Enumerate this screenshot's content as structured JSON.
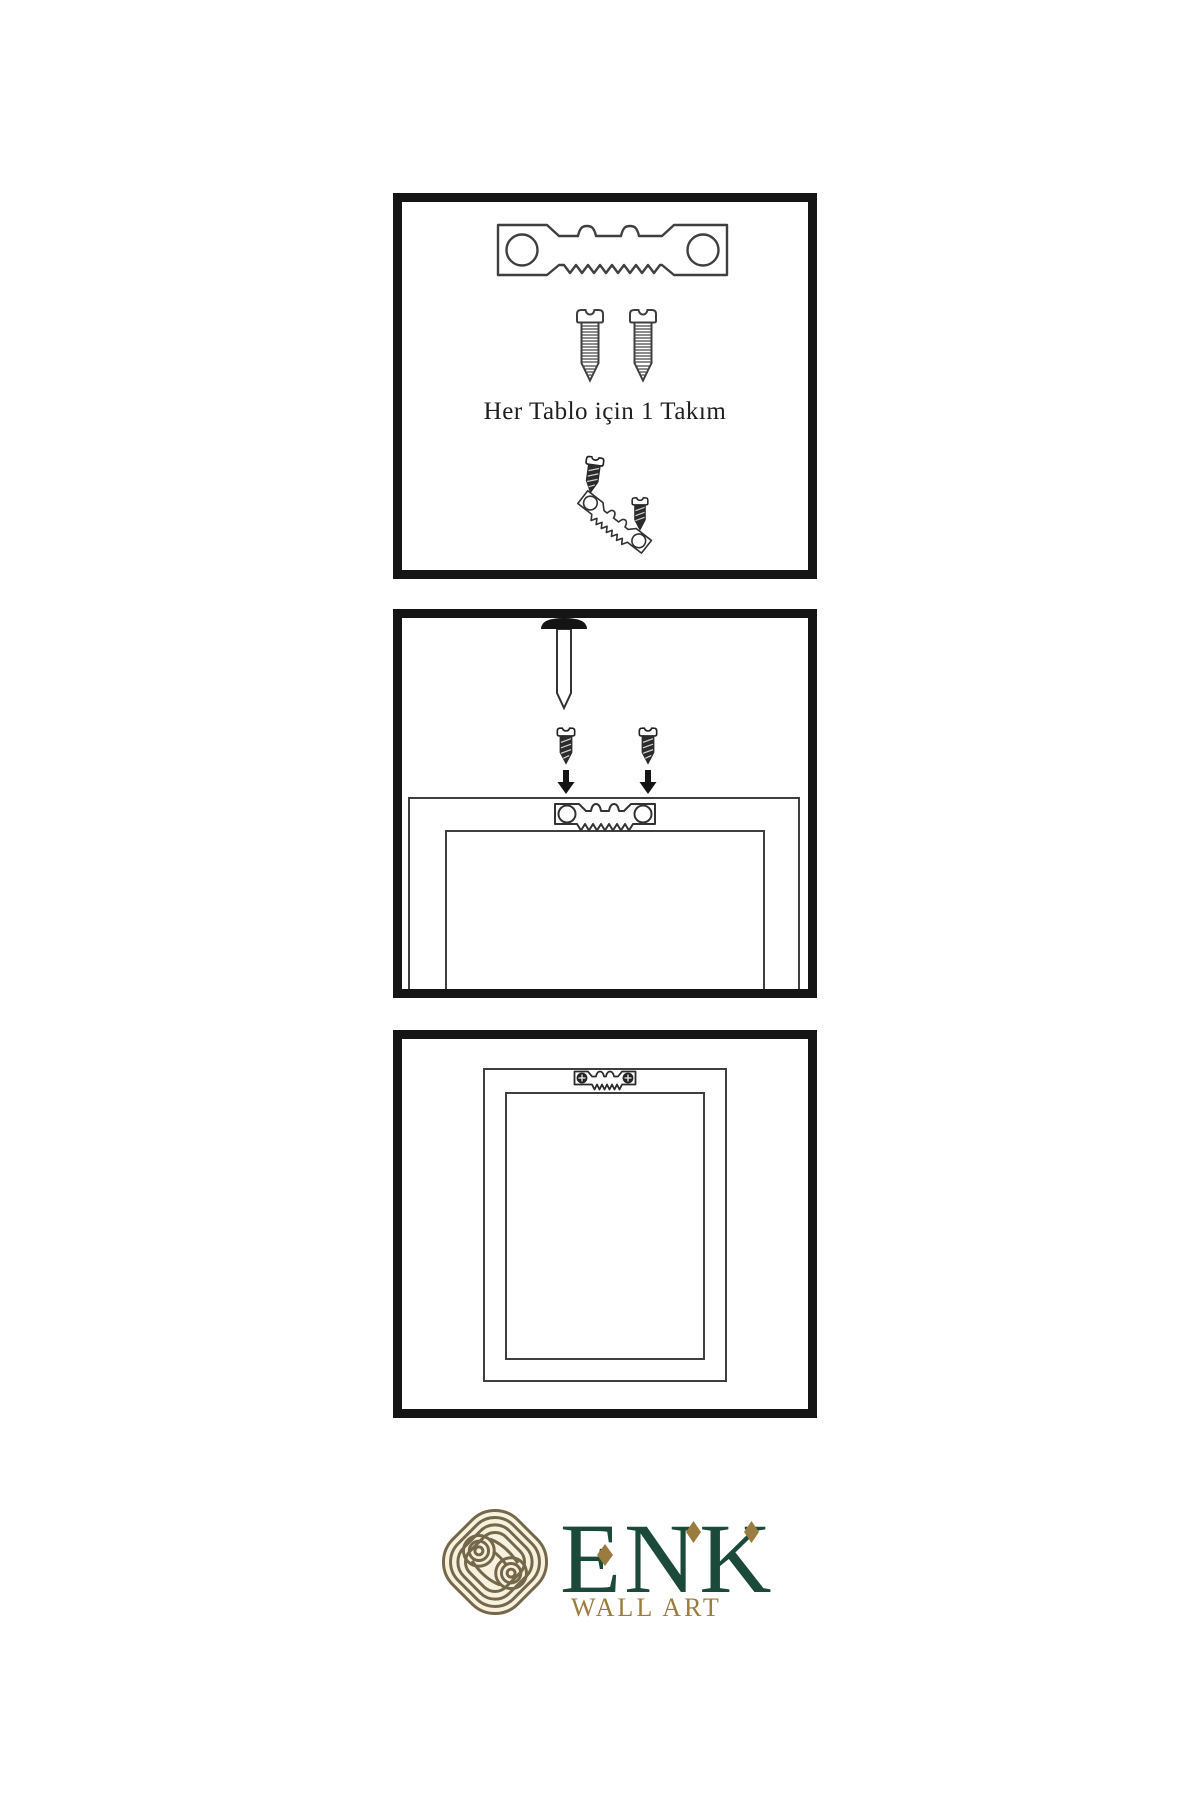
{
  "steps": [
    {
      "id": 1,
      "caption": "Her Tablo için 1 Takım",
      "icons": [
        "sawtooth-hanger",
        "screw",
        "screw",
        "screw-into-angled-hanger"
      ]
    },
    {
      "id": 2,
      "icons": [
        "wall-nail",
        "screw-with-down-arrow",
        "screw-with-down-arrow",
        "frame-back-with-sawtooth-hanger"
      ]
    },
    {
      "id": 3,
      "icons": [
        "hung-frame-with-installed-hanger"
      ]
    }
  ],
  "logo": {
    "brand": "ENK",
    "tagline": "WALL ART"
  },
  "theme": {
    "bg": "#ffffff",
    "ink": "#1f1f1f",
    "line": "#3f3f3f",
    "panel-border": "#151515",
    "logo-green": "#1b4a3b",
    "logo-gold": "#9a7c3e",
    "knot-gold": "#75684a",
    "knot-cream": "#f7f1df"
  }
}
